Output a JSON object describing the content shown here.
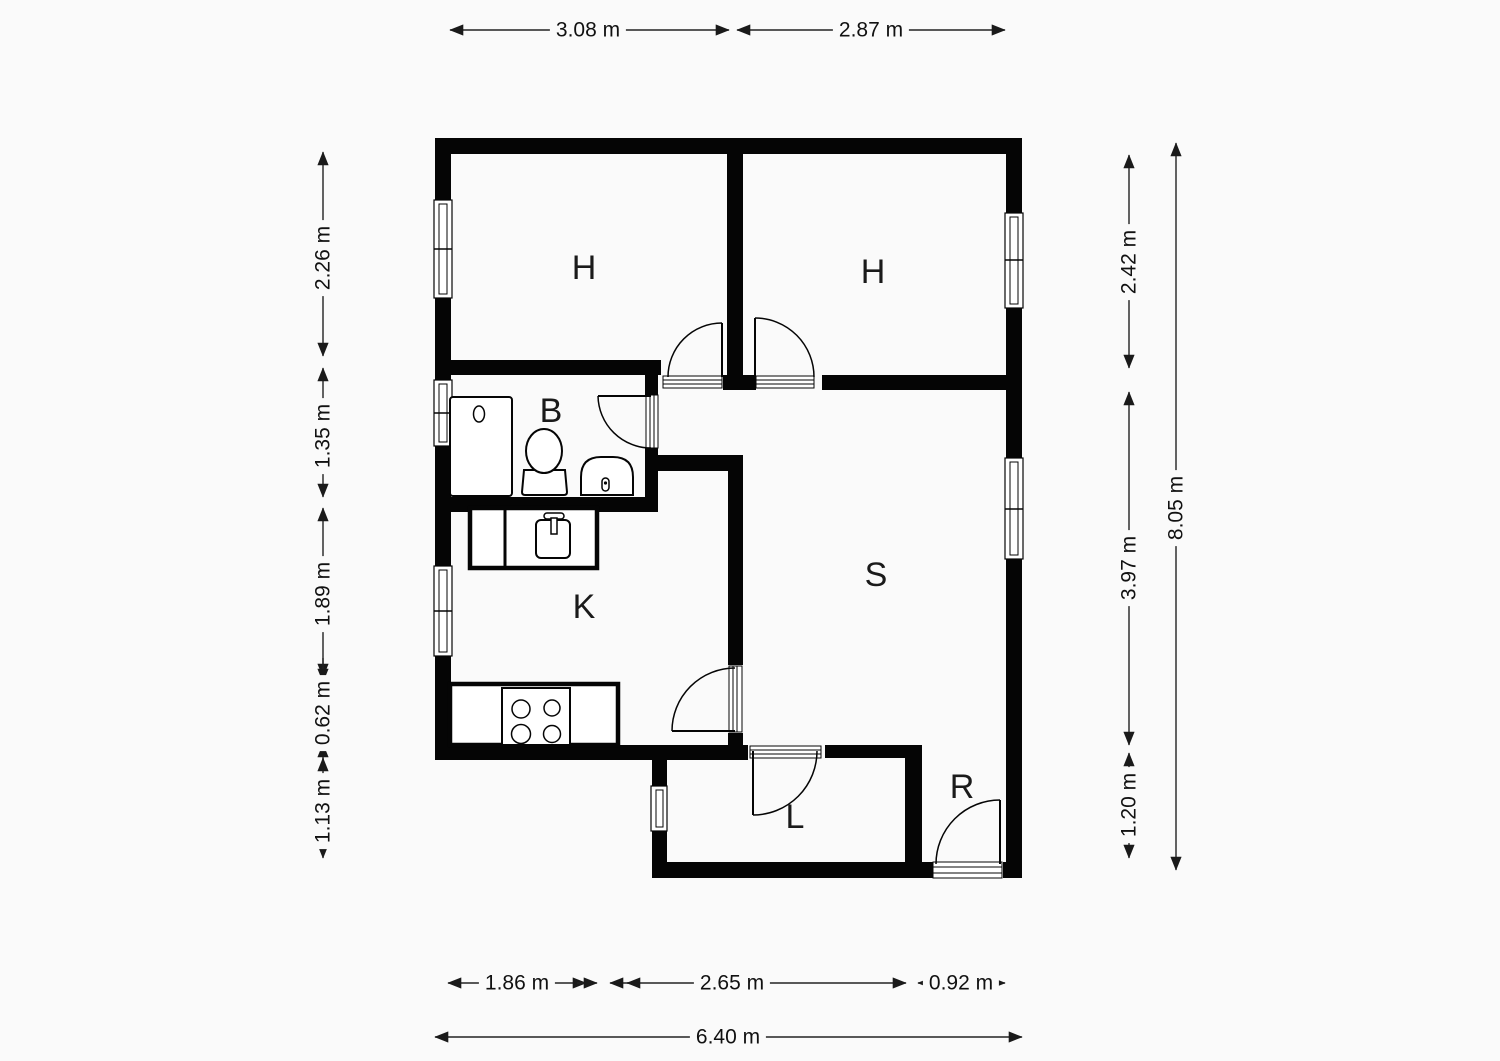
{
  "rooms": {
    "h_left": "H",
    "h_right": "H",
    "bath": "B",
    "kitchen": "K",
    "living": "S",
    "hall": "L",
    "entry": "R"
  },
  "dims": {
    "top_left_width": "3.08 m",
    "top_right_width": "2.87 m",
    "left_1": "2.26 m",
    "left_2": "1.35 m",
    "left_3": "1.89 m",
    "left_4": "0.62 m",
    "left_5": "1.13 m",
    "right_1": "2.42 m",
    "right_2": "3.97 m",
    "right_3": "1.20 m",
    "right_total": "8.05 m",
    "bottom_1": "1.86 m",
    "bottom_2": "2.65 m",
    "bottom_3": "0.92 m",
    "bottom_total": "6.40 m"
  },
  "colors": {
    "wall": "#050505",
    "background": "#fafafa",
    "dimension_line": "#222222",
    "text": "#111111"
  }
}
